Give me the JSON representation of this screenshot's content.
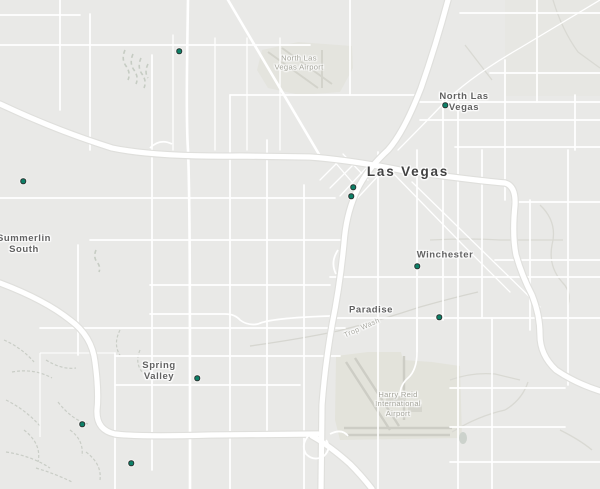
{
  "map": {
    "colors": {
      "background": "#e9e9e7",
      "road": "#ffffff",
      "marker": "#0c8168",
      "marker_ring": "#2a3431"
    },
    "labels": [
      {
        "name": "north-las-vegas-airport",
        "lines": [
          "North Las",
          "Vegas Airport"
        ],
        "x": 299,
        "y": 63,
        "type": "airport"
      },
      {
        "name": "north-las-vegas",
        "lines": [
          "North Las",
          "Vegas"
        ],
        "x": 464,
        "y": 103,
        "type": "city"
      },
      {
        "name": "las-vegas",
        "lines": [
          "Las Vegas"
        ],
        "x": 408,
        "y": 172,
        "type": "city-large"
      },
      {
        "name": "summerlin-south",
        "lines": [
          "Summerlin",
          "South"
        ],
        "x": 24,
        "y": 245,
        "type": "city"
      },
      {
        "name": "winchester",
        "lines": [
          "Winchester"
        ],
        "x": 445,
        "y": 256,
        "type": "city"
      },
      {
        "name": "paradise",
        "lines": [
          "Paradise"
        ],
        "x": 371,
        "y": 311,
        "type": "city"
      },
      {
        "name": "spring-valley",
        "lines": [
          "Spring",
          "Valley"
        ],
        "x": 159,
        "y": 372,
        "type": "city"
      },
      {
        "name": "harry-reid-international-airport",
        "lines": [
          "Harry Reid",
          "International",
          "Airport"
        ],
        "x": 398,
        "y": 404,
        "type": "airport"
      },
      {
        "name": "trop-wash",
        "lines": [
          "Trop Wash"
        ],
        "x": 362,
        "y": 328,
        "type": "wash",
        "rotate": -24
      }
    ],
    "markers": [
      {
        "x": 179,
        "y": 51
      },
      {
        "x": 23,
        "y": 181
      },
      {
        "x": 445,
        "y": 105
      },
      {
        "x": 353,
        "y": 187
      },
      {
        "x": 351,
        "y": 196
      },
      {
        "x": 417,
        "y": 266
      },
      {
        "x": 439,
        "y": 317
      },
      {
        "x": 197,
        "y": 378
      },
      {
        "x": 82,
        "y": 424
      },
      {
        "x": 131,
        "y": 463
      }
    ]
  }
}
